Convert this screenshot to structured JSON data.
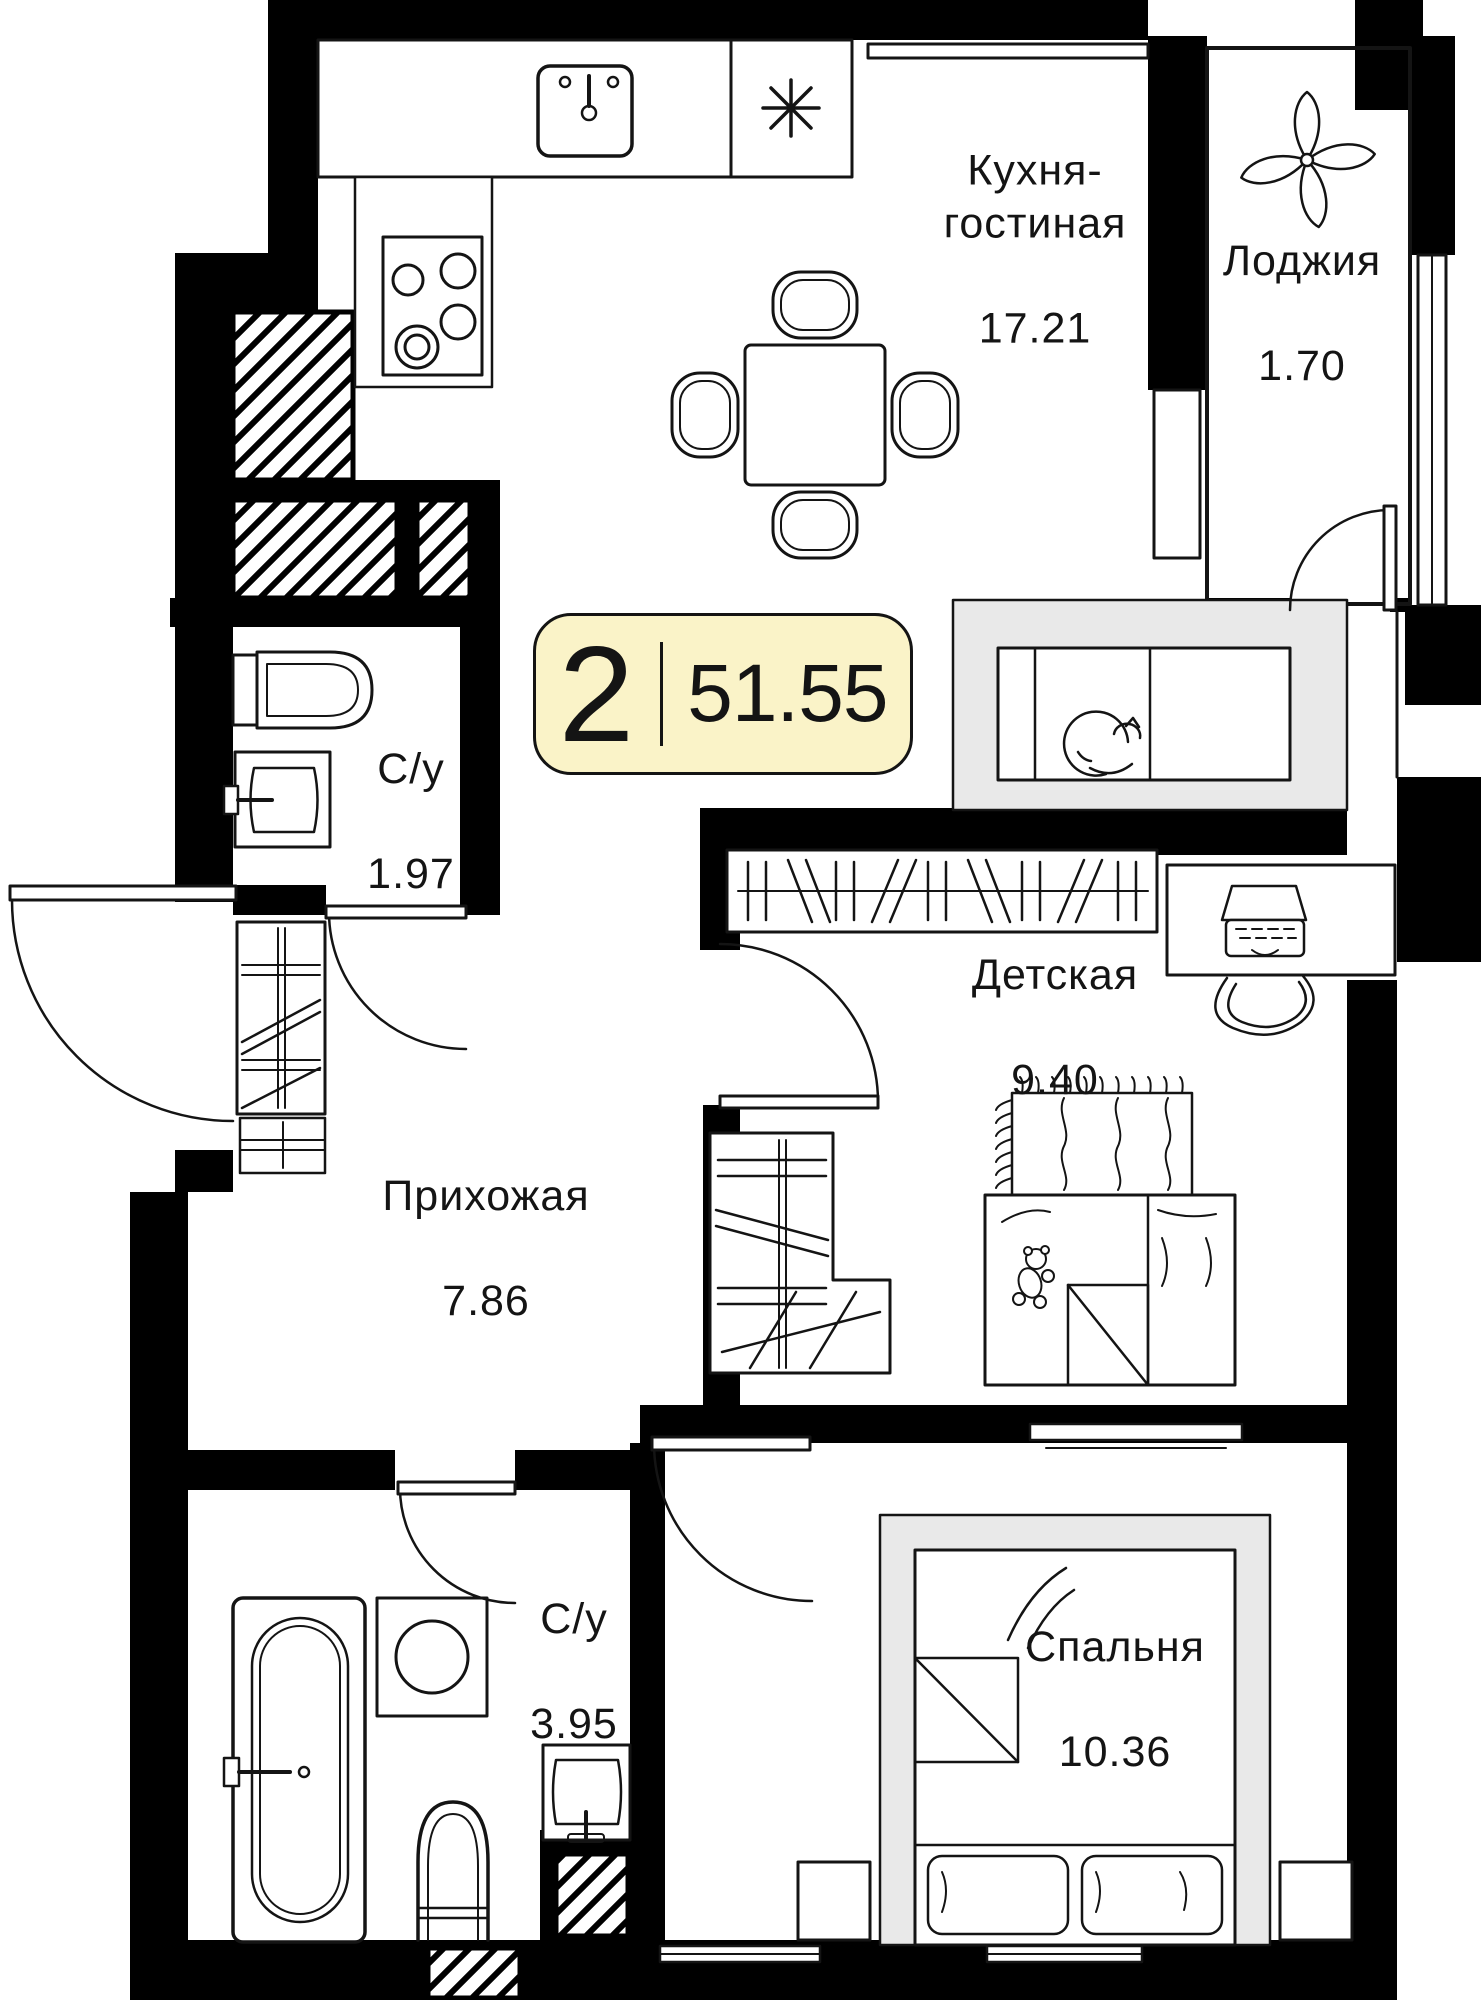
{
  "plan": {
    "badge": {
      "rooms_count": "2",
      "total_area": "51.55"
    },
    "rooms": [
      {
        "key": "kitchen_living",
        "name": "Кухня-\nгостиная",
        "area": "17.21"
      },
      {
        "key": "loggia",
        "name": "Лоджия",
        "area": "1.70"
      },
      {
        "key": "bathroom_small",
        "name": "С/у",
        "area": "1.97"
      },
      {
        "key": "children",
        "name": "Детская",
        "area": "9.40"
      },
      {
        "key": "hallway",
        "name": "Прихожая",
        "area": "7.86"
      },
      {
        "key": "bathroom_large",
        "name": "С/у",
        "area": "3.95"
      },
      {
        "key": "bedroom",
        "name": "Спальня",
        "area": "10.36"
      }
    ],
    "icons": [
      "kitchen-sink-icon",
      "cooktop-icon",
      "asterisk-icon",
      "dining-table-icon",
      "chair-icon",
      "sofa-icon",
      "cat-icon",
      "flower-icon",
      "wardrobe-icon",
      "desk-icon",
      "laptop-icon",
      "rug-icon",
      "child-bed-icon",
      "teddy-bear-icon",
      "toilet-icon",
      "washbasin-icon",
      "shelf-rack-icon",
      "bathtub-icon",
      "washing-machine-icon",
      "double-bed-icon",
      "nightstand-icon",
      "tv-icon",
      "door-arc",
      "window",
      "vent-shaft"
    ],
    "colors": {
      "wall": "#000000",
      "line": "#141414",
      "badge_bg": "#faf3c8",
      "badge_border": "#141414",
      "soft_grey": "#e9e9e9",
      "floor": "#ffffff"
    }
  }
}
